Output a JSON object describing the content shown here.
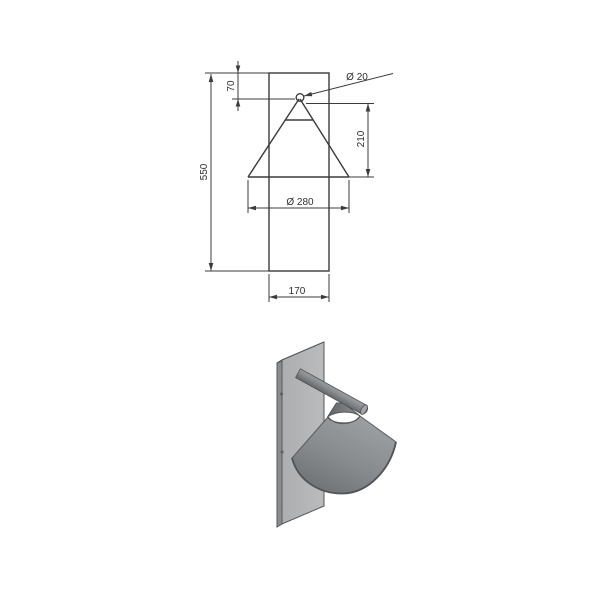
{
  "drawing": {
    "labels": {
      "spigot_diameter": "Ø 20",
      "apex_offset": "70",
      "shade_height": "210",
      "overall_height": "550",
      "shade_diameter": "Ø 280",
      "backplate_width": "170"
    },
    "line_color": "#3b3b3d",
    "text_color": "#2e2e30"
  },
  "render": {
    "plate_front_color": "#b3b5b7",
    "plate_side_color": "#8a8d8f",
    "plate_top_color": "#d6d7d8",
    "cone_light_color": "#9ea1a4",
    "cone_dark_color": "#6d7073",
    "cap_dark_color": "#606366",
    "cap_light_color": "#8f9295",
    "rod_light_color": "#aaadaf",
    "rod_dark_color": "#4f5255",
    "outline_color": "#55585a"
  }
}
